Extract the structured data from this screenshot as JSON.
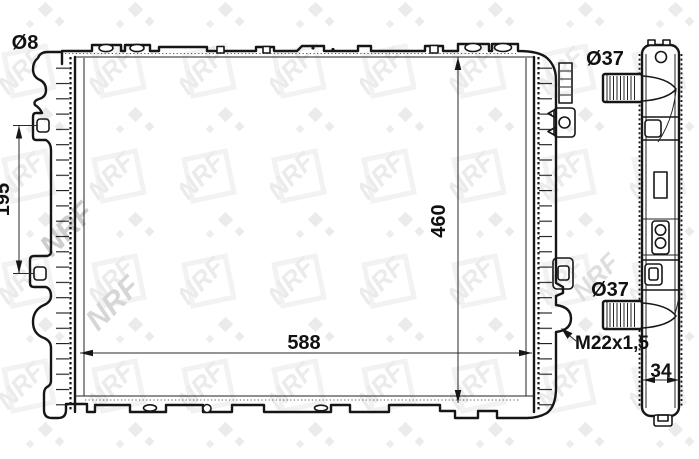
{
  "watermark": {
    "text": "NRF"
  },
  "labels": {
    "hole_diameter": "Ø8",
    "bracket_spacing": "195",
    "core_height": "460",
    "core_width": "588",
    "drain_thread": "M22x1,5",
    "inlet_diameter": "Ø37",
    "outlet_diameter": "Ø37",
    "depth": "34"
  },
  "colors": {
    "background": "#ffffff",
    "line": "#161616",
    "dimension": "#2a2a2a",
    "text": "#111111",
    "watermark_light": "#ebebeb",
    "watermark_mid": "#d6d6d6"
  }
}
